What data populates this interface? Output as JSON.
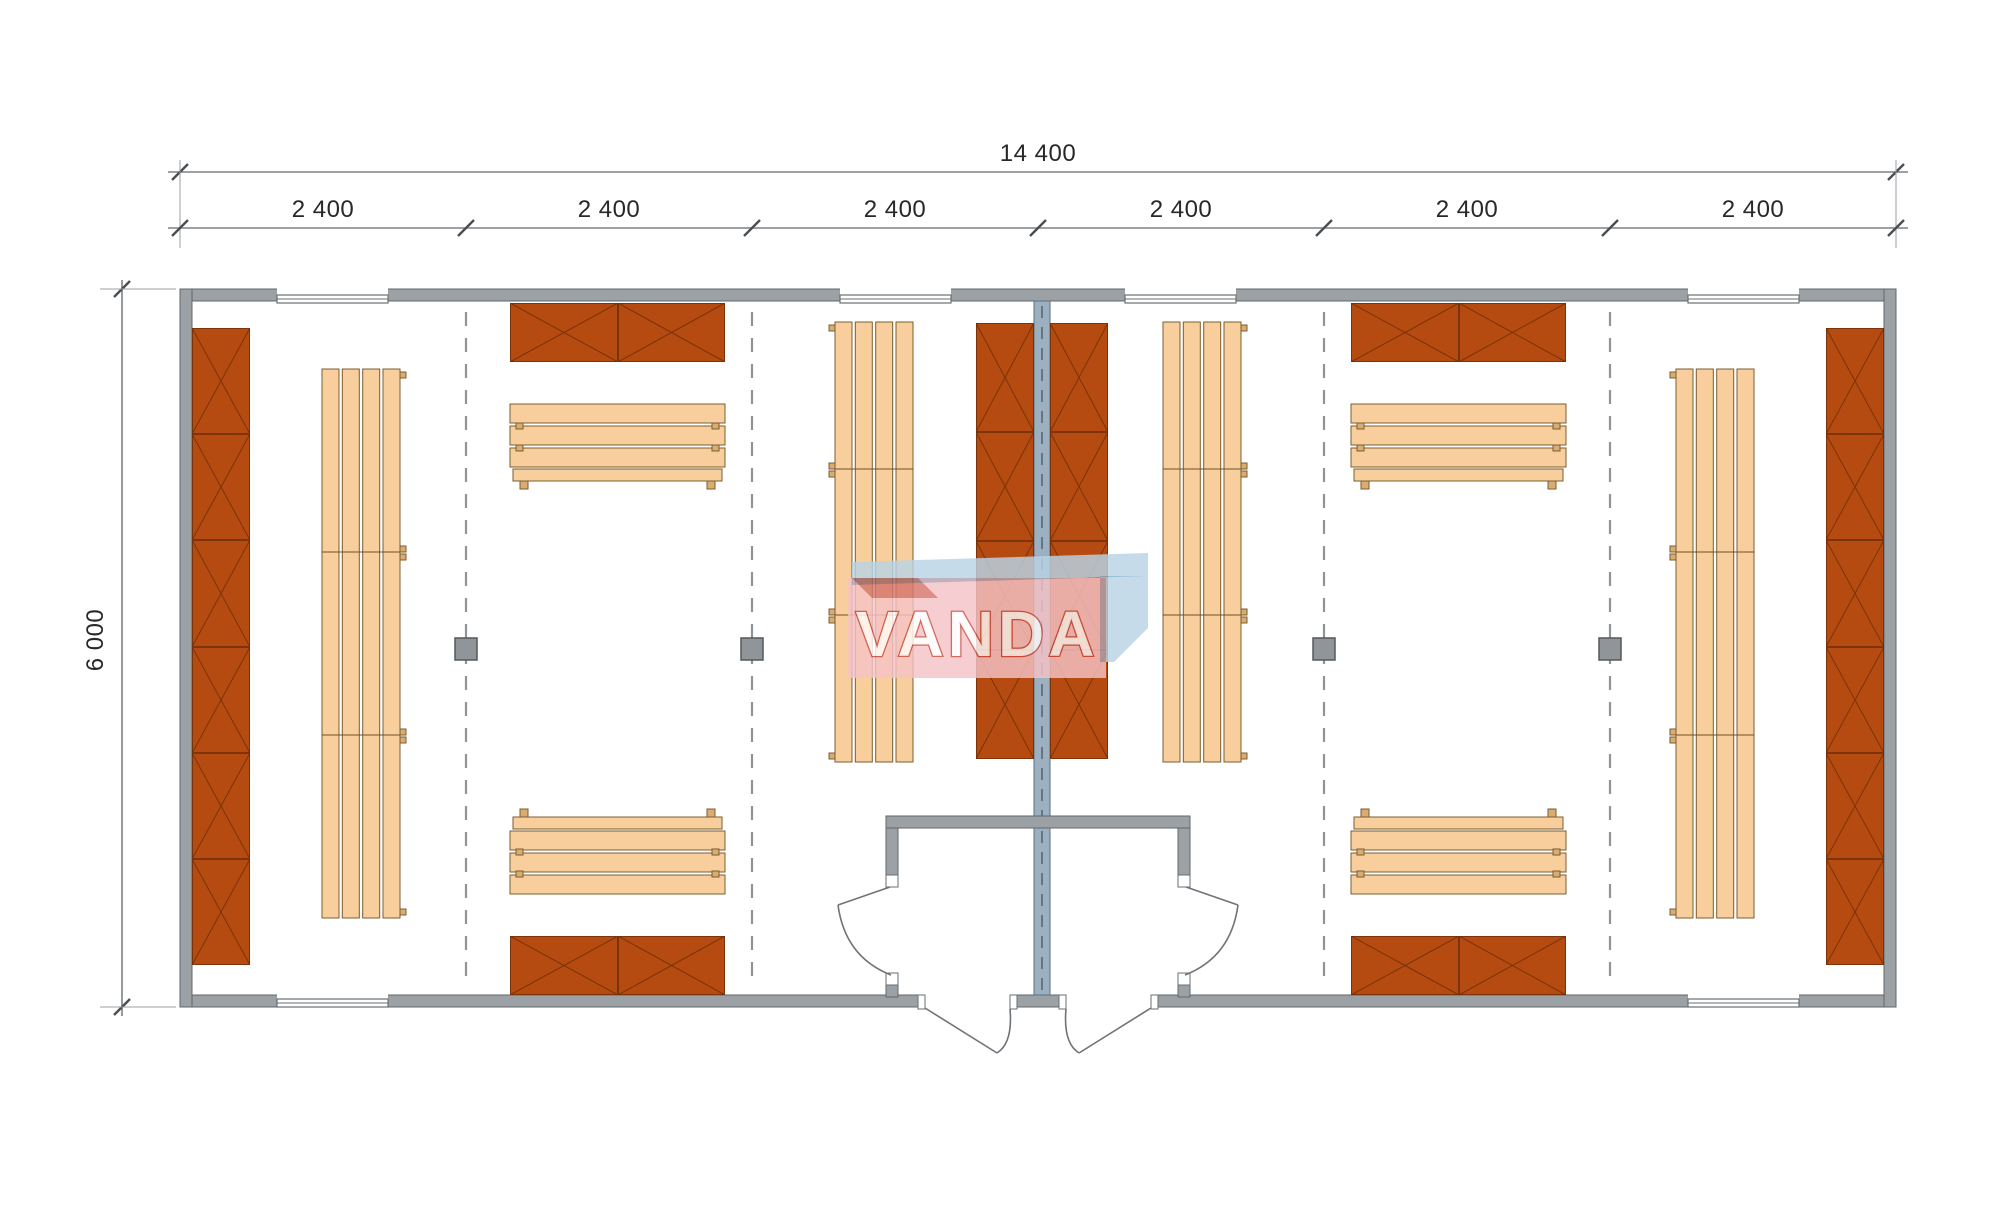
{
  "drawing": {
    "kind": "modular building floor plan",
    "dimensions": {
      "overall_width": "14 400",
      "overall_depth": "6 000",
      "modules": [
        "2 400",
        "2 400",
        "2 400",
        "2 400",
        "2 400",
        "2 400"
      ]
    },
    "watermark": {
      "text": "VANDA"
    },
    "inventory": {
      "module_count": 6,
      "rooms": 2,
      "windows": 6,
      "entrance_doors": 2,
      "room_doors": 2,
      "posts_on_module_lines": 4,
      "crossed_storage_cabinets": 8,
      "slatted_benches": 8
    },
    "colors": {
      "wall": "#9ba1a5",
      "wall_outline": "#62676b",
      "partition_wall": "#9db0bf",
      "cabinet": "#b54b10",
      "cabinet_outline": "#5e2506",
      "bench": "#f8cf9c",
      "bench_outline": "#7a5c30",
      "dashed_line": "#8f9497",
      "watermark_pink": "#f5c3c6",
      "watermark_blue": "#b9d4e6",
      "watermark_red": "#c94b40"
    }
  }
}
